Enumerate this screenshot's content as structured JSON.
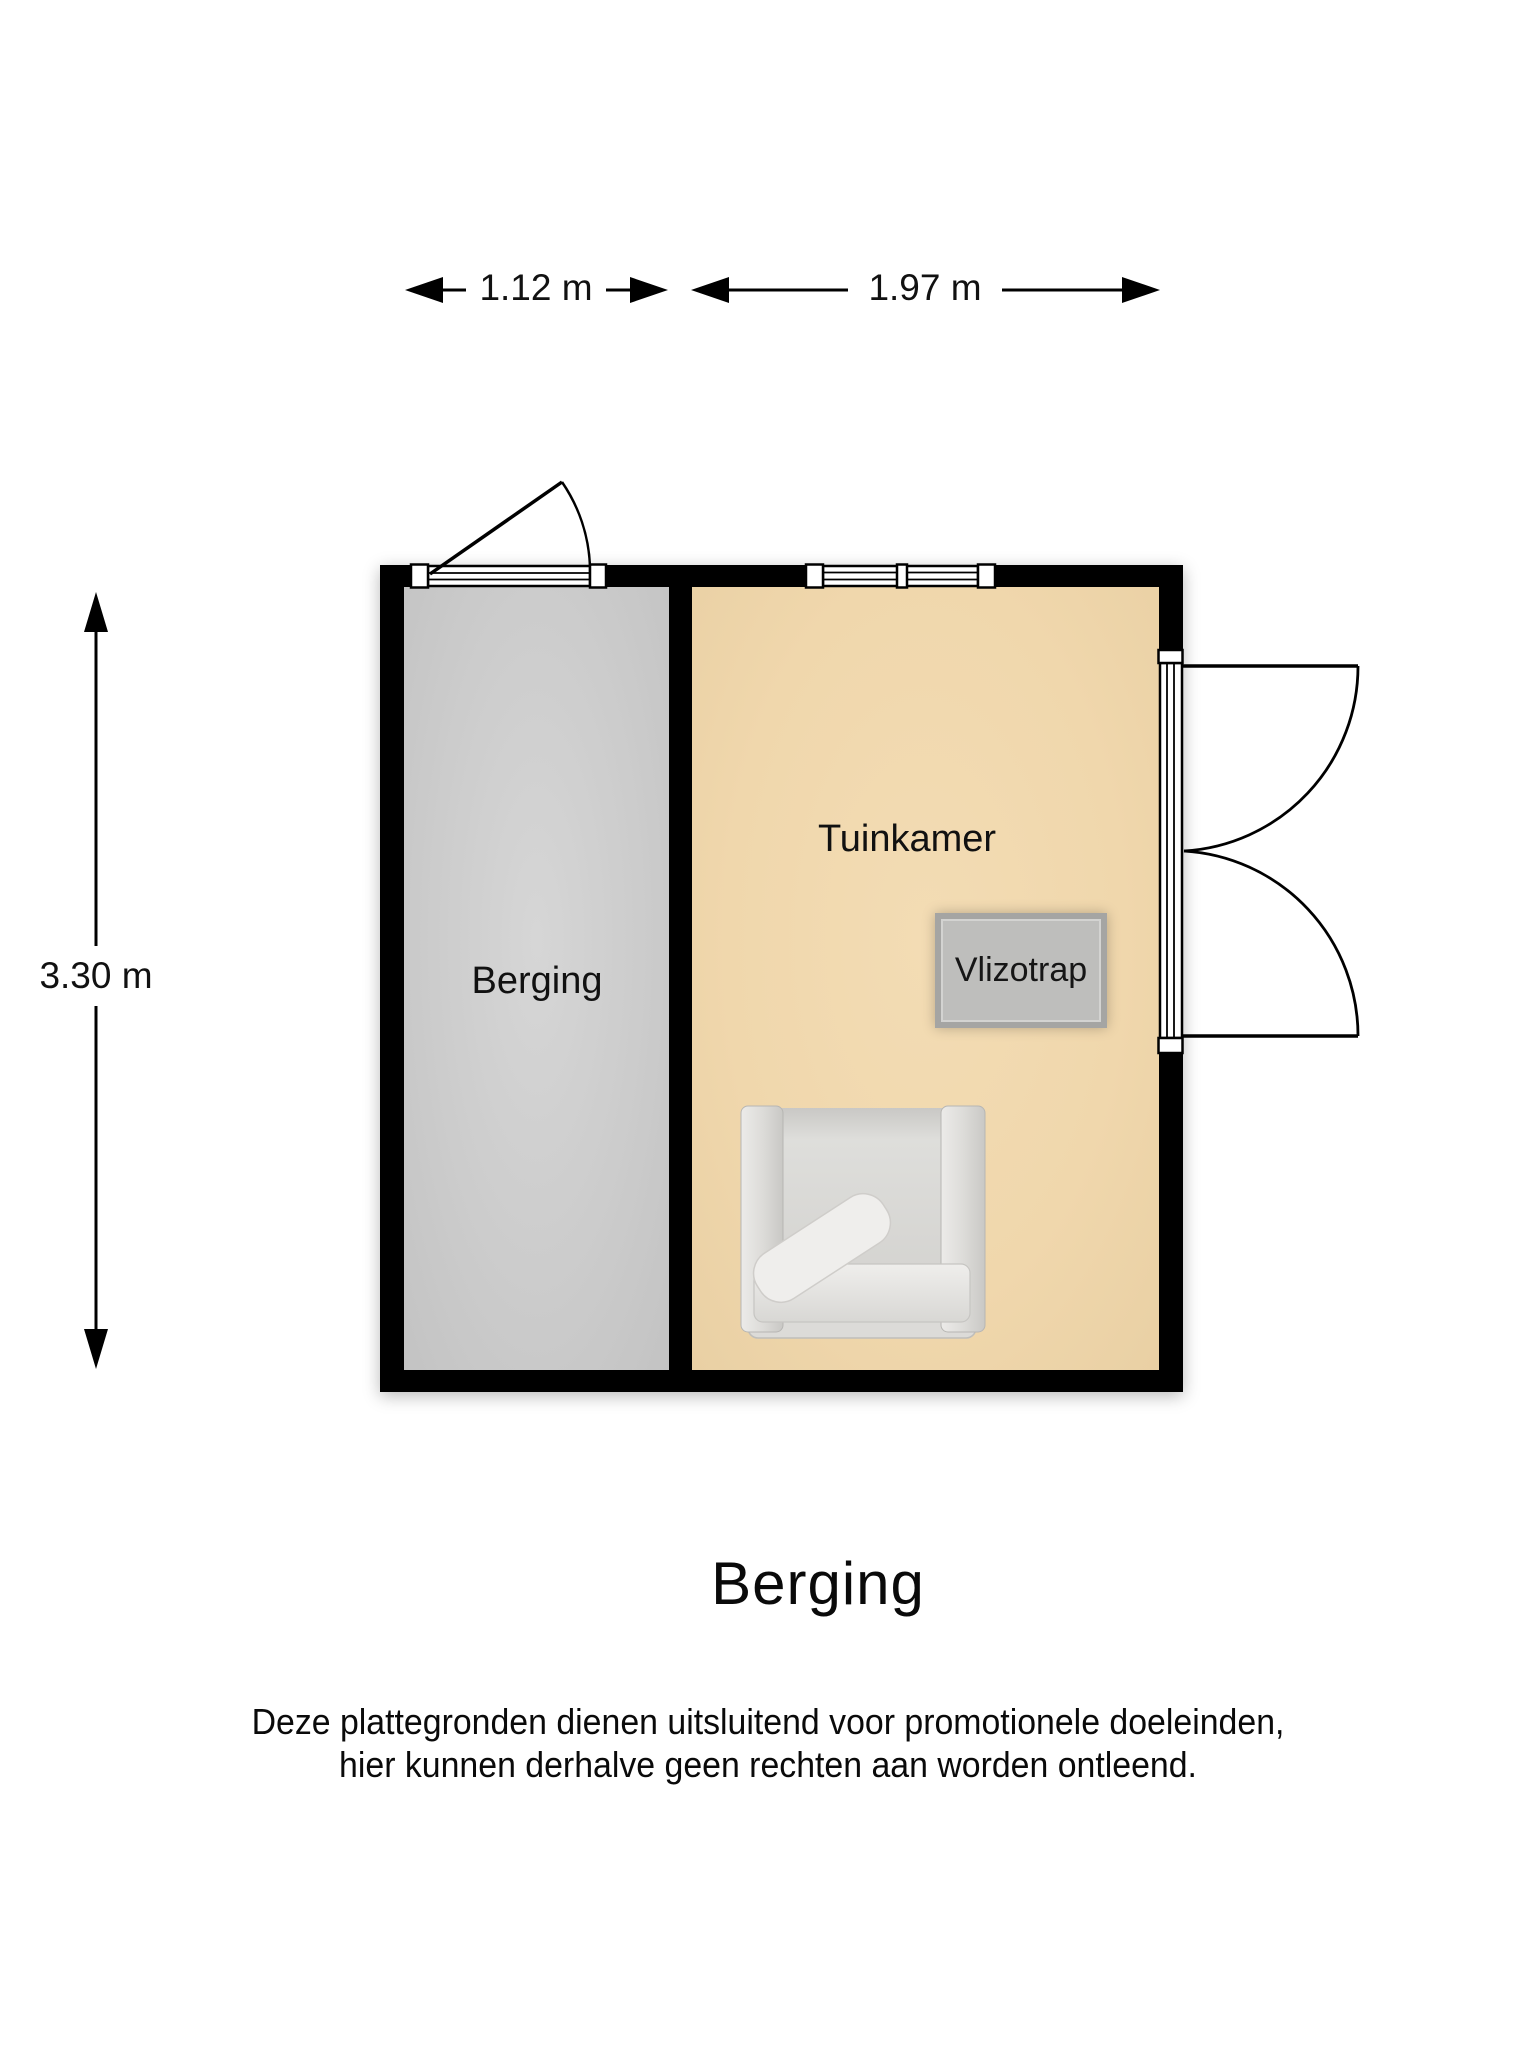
{
  "floor_plan": {
    "dimensions": {
      "berging_width": "1.12 m",
      "tuinkamer_width": "1.97 m",
      "height": "3.30 m"
    },
    "rooms": {
      "berging": {
        "label": "Berging"
      },
      "tuinkamer": {
        "label": "Tuinkamer"
      }
    },
    "features": {
      "vlizotrap_label": "Vlizotrap",
      "furniture": "armchair"
    }
  },
  "title": "Berging",
  "disclaimer": {
    "line1": "Deze plattegronden dienen uitsluitend voor promotionele doeleinden,",
    "line2": "hier kunnen derhalve geen rechten aan worden ontleend."
  },
  "colors": {
    "wall": "#000000",
    "berging_floor": "#c9c9c9",
    "tuinkamer_floor": "#f0d7ac",
    "vlizotrap_fill": "#bebebc",
    "vlizotrap_border": "#a5a5a3",
    "furniture": "#e6e5e3"
  }
}
